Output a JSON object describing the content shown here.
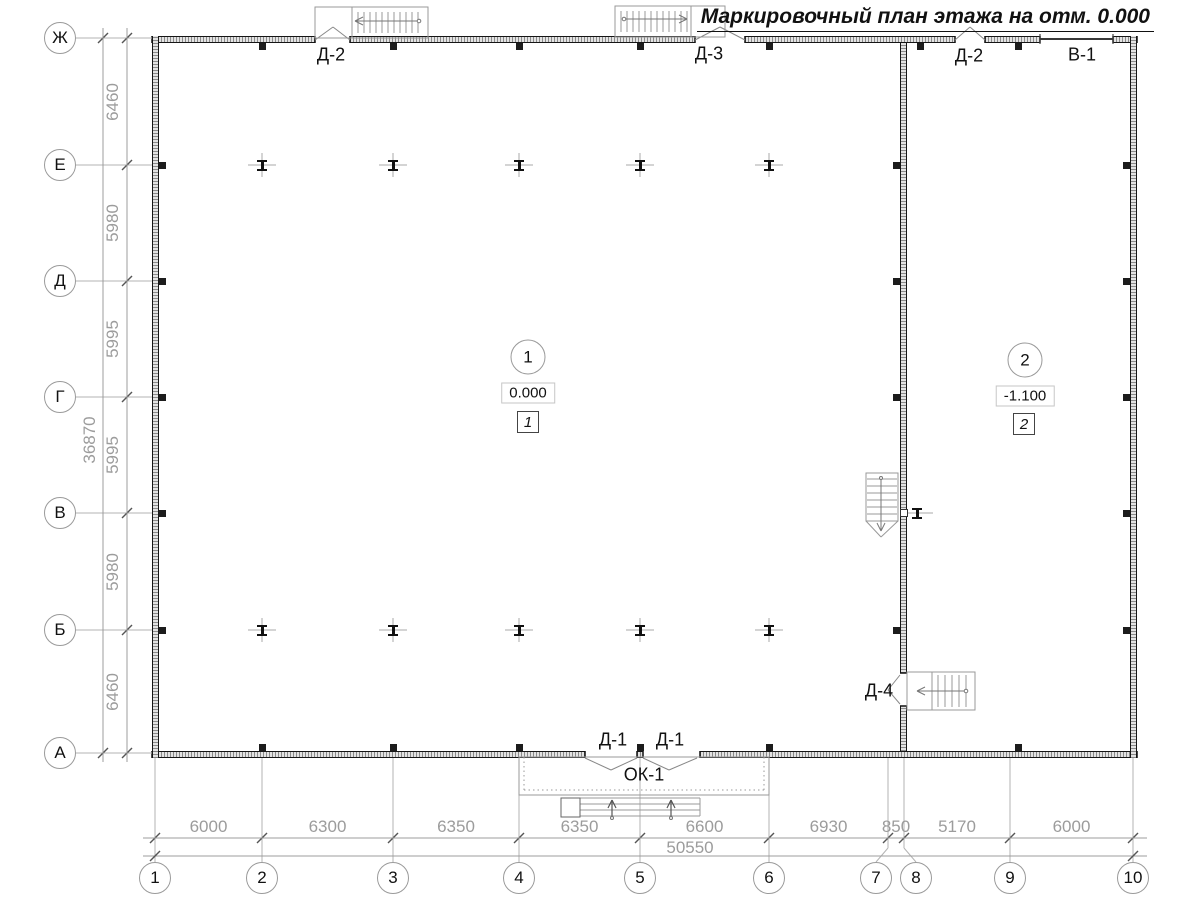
{
  "title": "Маркировочный план этажа на отм. 0.000",
  "axes": {
    "row_labels": [
      "Ж",
      "Е",
      "Д",
      "Г",
      "В",
      "Б",
      "А"
    ],
    "col_labels": [
      "1",
      "2",
      "3",
      "4",
      "5",
      "6",
      "7",
      "8",
      "9",
      "10"
    ]
  },
  "dimensions": {
    "left_segments": [
      "6460",
      "5980",
      "5995",
      "5995",
      "5980",
      "6460"
    ],
    "left_total": "36870",
    "bottom_segments": [
      "6000",
      "6300",
      "6350",
      "6350",
      "6600",
      "6930",
      "850",
      "5170",
      "6000"
    ],
    "bottom_total": "50550"
  },
  "openings": {
    "top_door_left": "Д-2",
    "top_door_mid": "Д-3",
    "top_door_right": "Д-2",
    "top_gate": "В-1",
    "bottom_door_left": "Д-1",
    "bottom_door_right": "Д-1",
    "bottom_window": "ОК-1",
    "divider_door": "Д-4"
  },
  "rooms": [
    {
      "number": "1",
      "elevation": "0.000",
      "tag": "1"
    },
    {
      "number": "2",
      "elevation": "-1.100",
      "tag": "2"
    }
  ],
  "colors": {
    "line_dark": "#1c1c1c",
    "line_gray": "#9c9c9c"
  }
}
